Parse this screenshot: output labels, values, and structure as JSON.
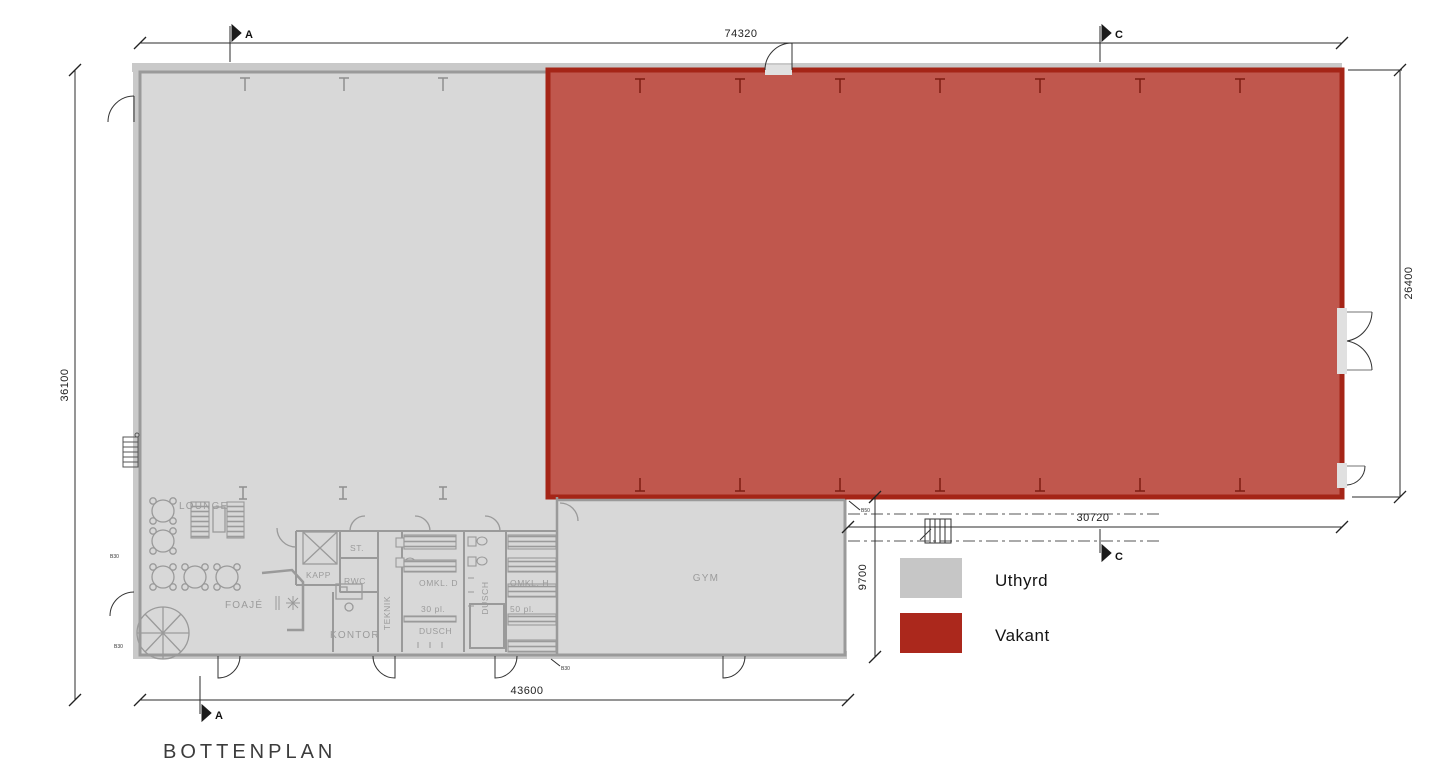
{
  "title": "BOTTENPLAN",
  "legend": {
    "items": [
      {
        "label": "Uthyrd",
        "color": "#c6c6c6"
      },
      {
        "label": "Vakant",
        "color": "#ab281c"
      }
    ]
  },
  "dimensions": {
    "top_width": "74320",
    "left_height": "36100",
    "right_height": "26400",
    "vacant_width": "30720",
    "gym_depth": "9700",
    "bottom_width": "43600"
  },
  "section_markers": {
    "a": "A",
    "c": "C"
  },
  "rooms": {
    "lounge": "LOUNGE",
    "foaje": "FOAJÉ",
    "kapp": "KAPP",
    "st": "ST.",
    "rwc": "RWC",
    "kontor": "KONTOR",
    "teknik": "TEKNIK",
    "omkl_d": "OMKL. D",
    "omkl_d_capacity": "30 pl.",
    "dusch": "DUSCH",
    "dusch_corridor": "DUSCH",
    "omkl_h": "OMKL. H",
    "omkl_h_capacity": "50 pl.",
    "gym": "GYM"
  },
  "tiny_markers": {
    "left_upper": "B30",
    "left_lower": "B30",
    "gym_bottom": "B30",
    "gym_corner": "B50"
  },
  "colors": {
    "uthyrd_fill": "#d8d8d8",
    "uthyrd_wall": "#9a9a9a",
    "vakant_fill": "#c0574d",
    "vakant_wall": "#a52517"
  }
}
